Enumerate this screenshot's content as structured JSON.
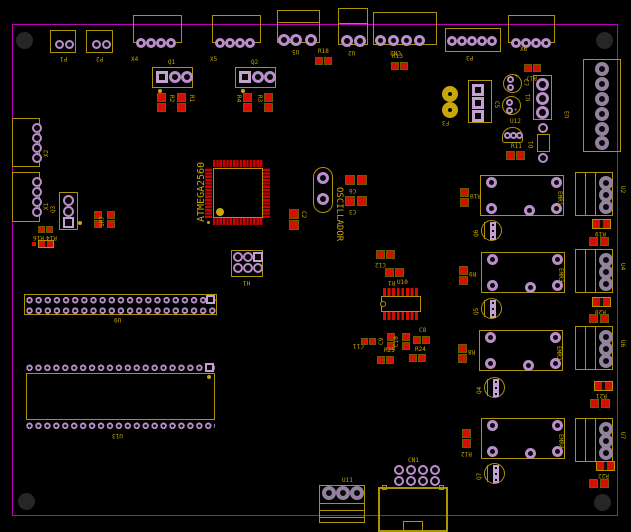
{
  "colors": {
    "background": "#000000",
    "board_edge": "#bf00bf",
    "silkscreen": "#ad9400",
    "smd_pad": "#d41000",
    "hole_ring": "#b98fc9",
    "label_text": "#c9a600"
  },
  "refs": {
    "plus": "+",
    "p1": "P1",
    "p2": "P2",
    "x4": "X4",
    "x5": "X5",
    "u5": "U5",
    "u2_top": "U2",
    "cn2": "CN2",
    "p3": "P3",
    "x6": "X6",
    "r18": "R18",
    "r13": "R13",
    "r17": "R17",
    "x2": "X2",
    "x1": "X1",
    "q3": "Q3",
    "sr7": "SR7",
    "r16": "R16",
    "r14": "R14",
    "q1": "Q1",
    "r2": "R2",
    "r1": "R1",
    "q2": "Q2",
    "r4": "R4",
    "r3": "R3",
    "mcu": "ATMEGA2560",
    "osc": "OSCILLADOR",
    "c2": "C2",
    "c6": "C6",
    "c3": "C3",
    "h1": "H1",
    "u9": "U9",
    "u13": "U13",
    "u10": "U10",
    "c12": "C12",
    "r1b": "R1",
    "c11": "C11",
    "c9": "C9",
    "c10": "C10",
    "c8": "C8",
    "r25": "R25",
    "r24": "R24",
    "f3": "F3",
    "c7": "C7",
    "c5": "C5",
    "u12": "U12",
    "r11": "R11",
    "u1": "U1",
    "d1": "D1",
    "u3": "U3",
    "emr1": "EMR1",
    "emr3": "EMR3",
    "emr2": "EMR2",
    "emr4": "EMR4",
    "q6": "Q6",
    "q5": "Q5",
    "q4": "Q4",
    "q7": "Q7",
    "r10": "R10",
    "r9": "R9",
    "r8": "R8",
    "r12": "R12",
    "u2_right": "U2",
    "u4": "U4",
    "u6": "U6",
    "u7": "U7",
    "r19": "R19",
    "r20": "R20",
    "r21": "R21",
    "r22": "R22",
    "cn1": "CN1",
    "u11": "U11"
  }
}
